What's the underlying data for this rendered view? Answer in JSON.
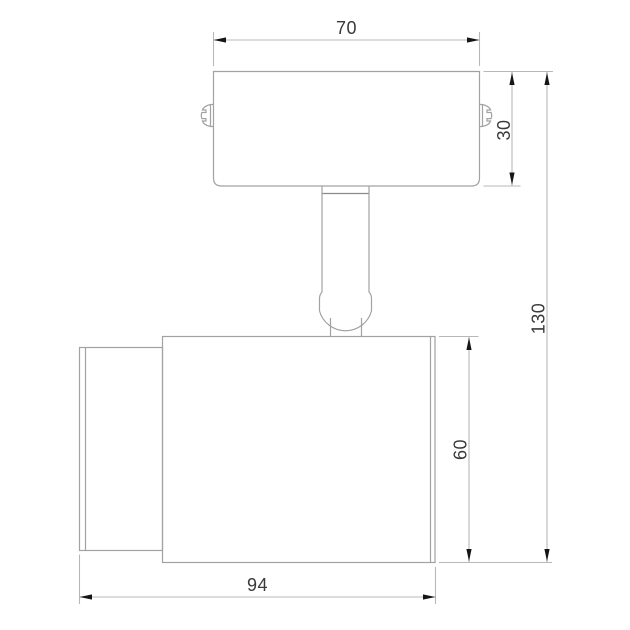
{
  "drawing": {
    "subject": "spotlight fixture side-view technical drawing",
    "dimensions": {
      "plate_width": "70",
      "plate_height": "30",
      "overall_height": "130",
      "body_height": "60",
      "body_length": "94"
    },
    "colors": {
      "background": "#ffffff",
      "outline": "#a2a2a2",
      "dimension_line": "#b8b8b8",
      "arrow": "#161616",
      "text": "#3a3a3a"
    }
  }
}
